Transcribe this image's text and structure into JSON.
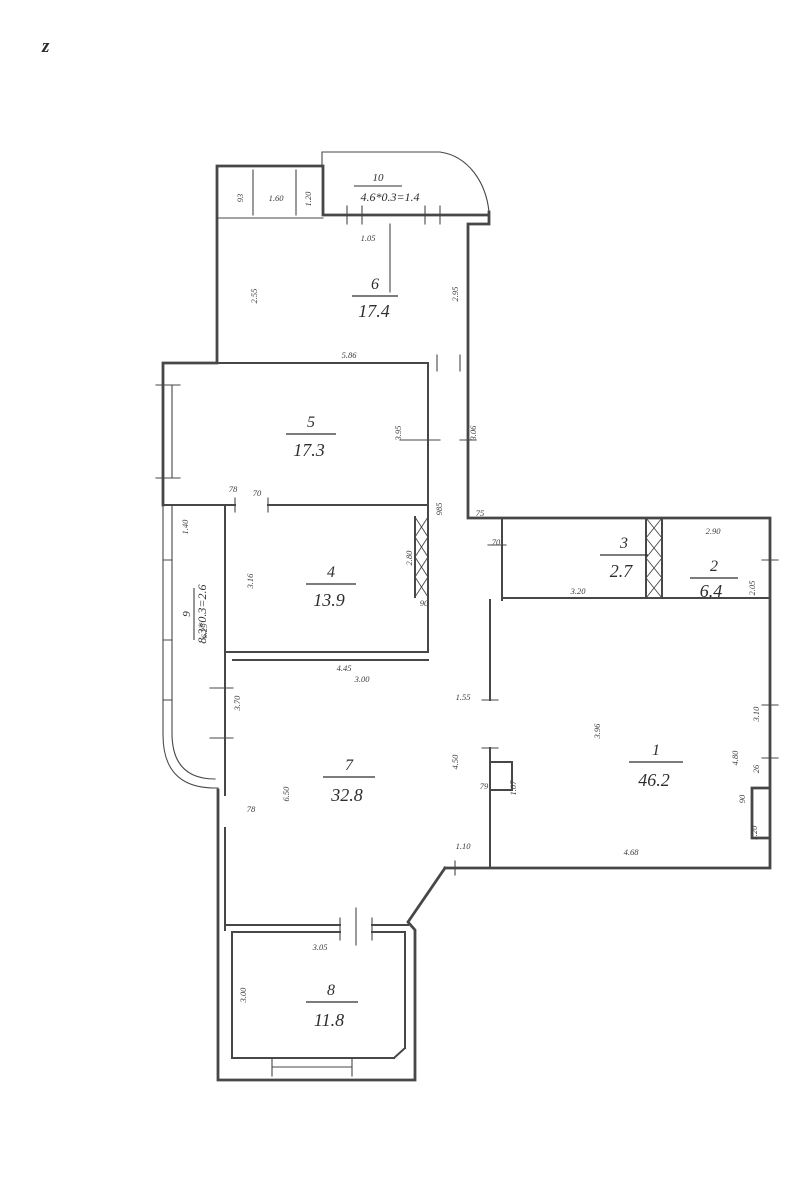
{
  "page": {
    "corner_mark": "z",
    "background": "#ffffff",
    "line_color": "#474747",
    "text_color": "#2e2e2e"
  },
  "plan": {
    "type": "apartment-floor-plan",
    "rooms": [
      {
        "number": "1",
        "area": "46.2"
      },
      {
        "number": "2",
        "area": "6.4"
      },
      {
        "number": "3",
        "area": "2.7"
      },
      {
        "number": "4",
        "area": "13.9"
      },
      {
        "number": "5",
        "area": "17.3"
      },
      {
        "number": "6",
        "area": "17.4"
      },
      {
        "number": "7",
        "area": "32.8"
      },
      {
        "number": "8",
        "area": "11.8"
      },
      {
        "number": "9",
        "area": "8.3*0.3=2.6"
      },
      {
        "number": "10",
        "area": "4.6*0.3=1.4"
      }
    ],
    "dimensions": [
      "1.05",
      "93",
      "1.60",
      "1.20",
      "2.55",
      "2.95",
      "5.86",
      "3.95",
      "3.06",
      "78",
      "70",
      "1.40",
      "6.29",
      "3.16",
      "2.80",
      "4.45",
      "90",
      "75",
      "70",
      "3.20",
      "2.90",
      "2.05",
      "3.10",
      "4.80",
      "26",
      "90",
      "1.20",
      "4.68",
      "1.10",
      "3.96",
      "3.00",
      "4.50",
      "79",
      "1.07",
      "3.70",
      "6.50",
      "78",
      "3.05",
      "3.00",
      "1.55",
      "985"
    ]
  }
}
